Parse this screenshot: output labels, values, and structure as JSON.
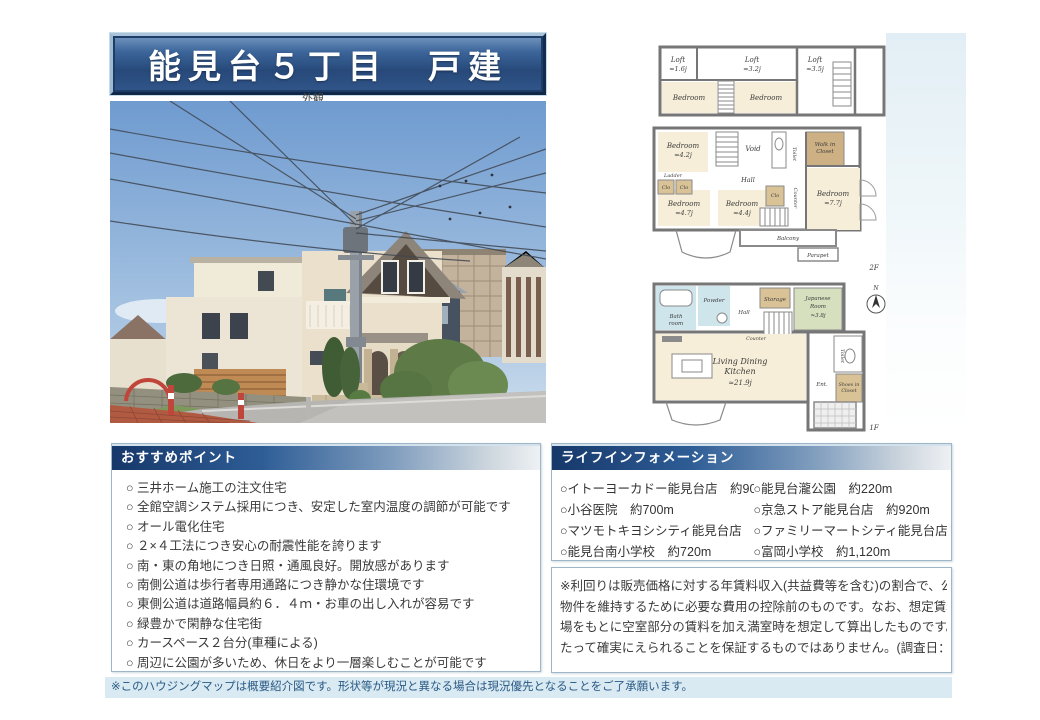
{
  "page": {
    "title": "能見台５丁目　戸建",
    "photo_caption": "外観",
    "footer_note": "※このハウジングマップは概要紹介図です。形状等が現況と異なる場合は現況優先となることをご了承願います。"
  },
  "colors": {
    "banner_blue": "#2d5184",
    "section_header_navy": "#16386a",
    "footer_bg": "#d9eaf2",
    "footer_text": "#2a5a86"
  },
  "recommend": {
    "header": "おすすめポイント",
    "items": [
      "○ 三井ホーム施工の注文住宅",
      "○ 全館空調システム採用につき、安定した室内温度の調節が可能です",
      "○ オール電化住宅",
      "○ ２×４工法につき安心の耐震性能を誇ります",
      "○ 南・東の角地につき日照・通風良好。開放感があります",
      "○ 南側公道は歩行者専用通路につき静かな住環境です",
      "○ 東側公道は道路幅員約６．４ｍ・お車の出し入れが容易です",
      "○ 緑豊かで閑静な住宅街",
      "○ カースペース２台分(車種による)",
      "○ 周辺に公園が多いため、休日をより一層楽しむことが可能です"
    ]
  },
  "life_info": {
    "header": "ライフインフォメーション",
    "left_items": [
      "○イトーヨーカドー能見台店　約900m",
      "○小谷医院　約700m",
      "○マツモトキヨシシティ能見台店　約500m",
      "○能見台南小学校　約720m"
    ],
    "right_items": [
      "○能見台瀧公園　約220m",
      "○京急ストア能見台店　約920m",
      "○ファミリーマートシティ能見台店　約400m",
      "○富岡小学校　約1,120m"
    ]
  },
  "disclaimer": {
    "lines": [
      "※利回りは販売価格に対する年賃料収入(共益費等を含む)の割合で、公租公課その他当該",
      "物件を維持するために必要な費用の控除前のものです。なお、想定賃料想定利回りは賃料相",
      "場をもとに空室部分の賃料を加え満室時を想定して算出したものです。※賃料収入は将来にわ",
      "たって確実にえられることを保証するものではありません。(調査日：令和元年11月30日)"
    ]
  },
  "floorplan": {
    "label_loft": "Loft",
    "size_loft_a": "≈1.6j",
    "size_loft_b": "≈3.2j",
    "size_loft_c": "≈3.5j",
    "label_bedroom": "Bedroom",
    "size_bed_a": "≈4.2j",
    "size_bed_b": "≈4.7j",
    "size_bed_c": "≈4.4j",
    "size_bed_d": "≈7.7j",
    "label_ladder": "Ladder",
    "label_clo": "Clo",
    "label_void": "Void",
    "label_hall": "Hall",
    "label_toilet": "Toilet",
    "label_counter": "Counter",
    "label_wic_1": "Walk in",
    "label_wic_2": "Closet",
    "label_balcony": "Balcony",
    "label_parapet": "Parapet",
    "label_2f": "2F",
    "label_bath_1": "Bath",
    "label_bath_2": "room",
    "label_powder": "Powder",
    "label_storage": "Storage",
    "label_japanese_1": "Japanese",
    "label_japanese_2": "Room",
    "size_japanese": "≈3.8j",
    "label_ldk_1": "Living Dining",
    "label_ldk_2": "Kitchen",
    "size_ldk": "≈21.9j",
    "label_ent": "Ent.",
    "label_sic_1": "Shoes in",
    "label_sic_2": "Closet",
    "label_1f": "1F",
    "label_north": "N"
  }
}
